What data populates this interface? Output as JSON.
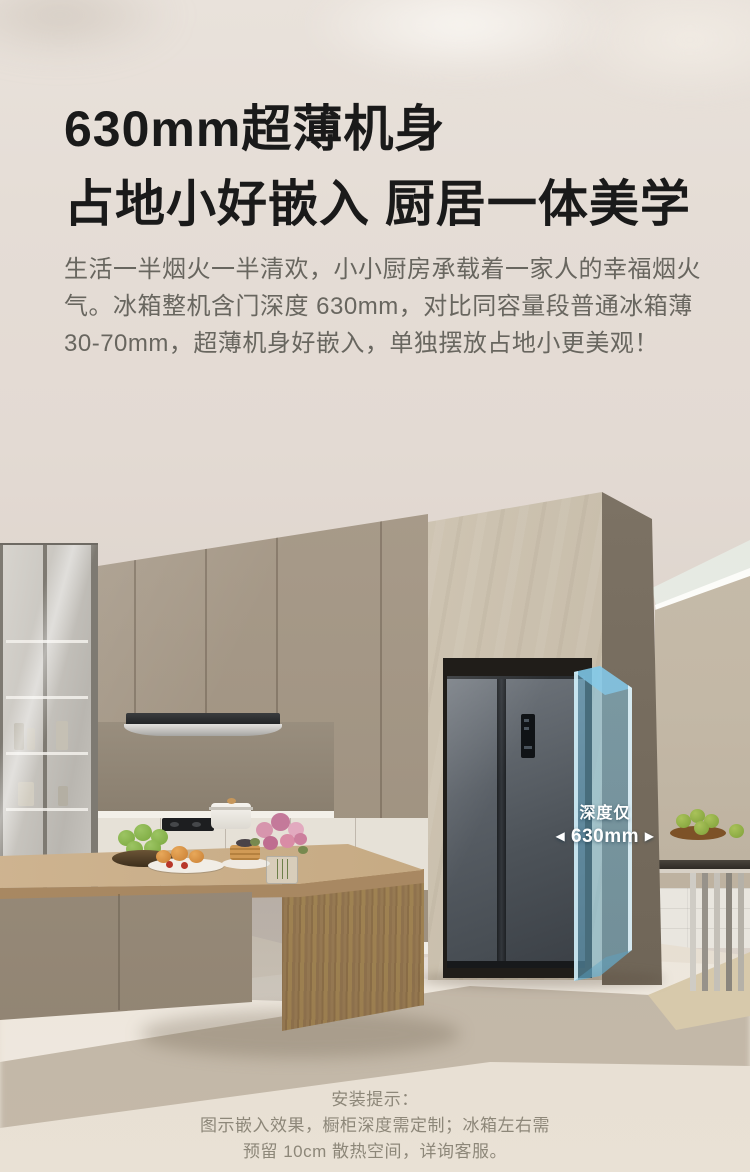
{
  "header": {
    "title_line1": "630mm超薄机身",
    "title_line2": "占地小好嵌入 厨居一体美学",
    "body_lines": [
      "生活一半烟火一半清欢，小小厨房承载着一家人的幸福烟火",
      "气。冰箱整机含门深度 630mm，对比同容量段普通冰箱薄",
      "30-70mm，超薄机身好嵌入，单独摆放占地小更美观！"
    ]
  },
  "scene": {
    "depth_callout": {
      "title": "深度仅",
      "arrow_left": "◀",
      "value": "630mm",
      "arrow_right": "▶"
    },
    "colors": {
      "highlight_blue": "#7CC5E8",
      "fridge_body": "#4A5057",
      "stone_column": "#CCC2B1",
      "cabinet_taupe": "#A89B8A",
      "wall": "#E3DAD3",
      "floor": "#EAE3D9"
    }
  },
  "footer": {
    "lines": [
      "安装提示：",
      "图示嵌入效果，橱柜深度需定制；冰箱左右需",
      "预留 10cm 散热空间，详询客服。"
    ]
  }
}
